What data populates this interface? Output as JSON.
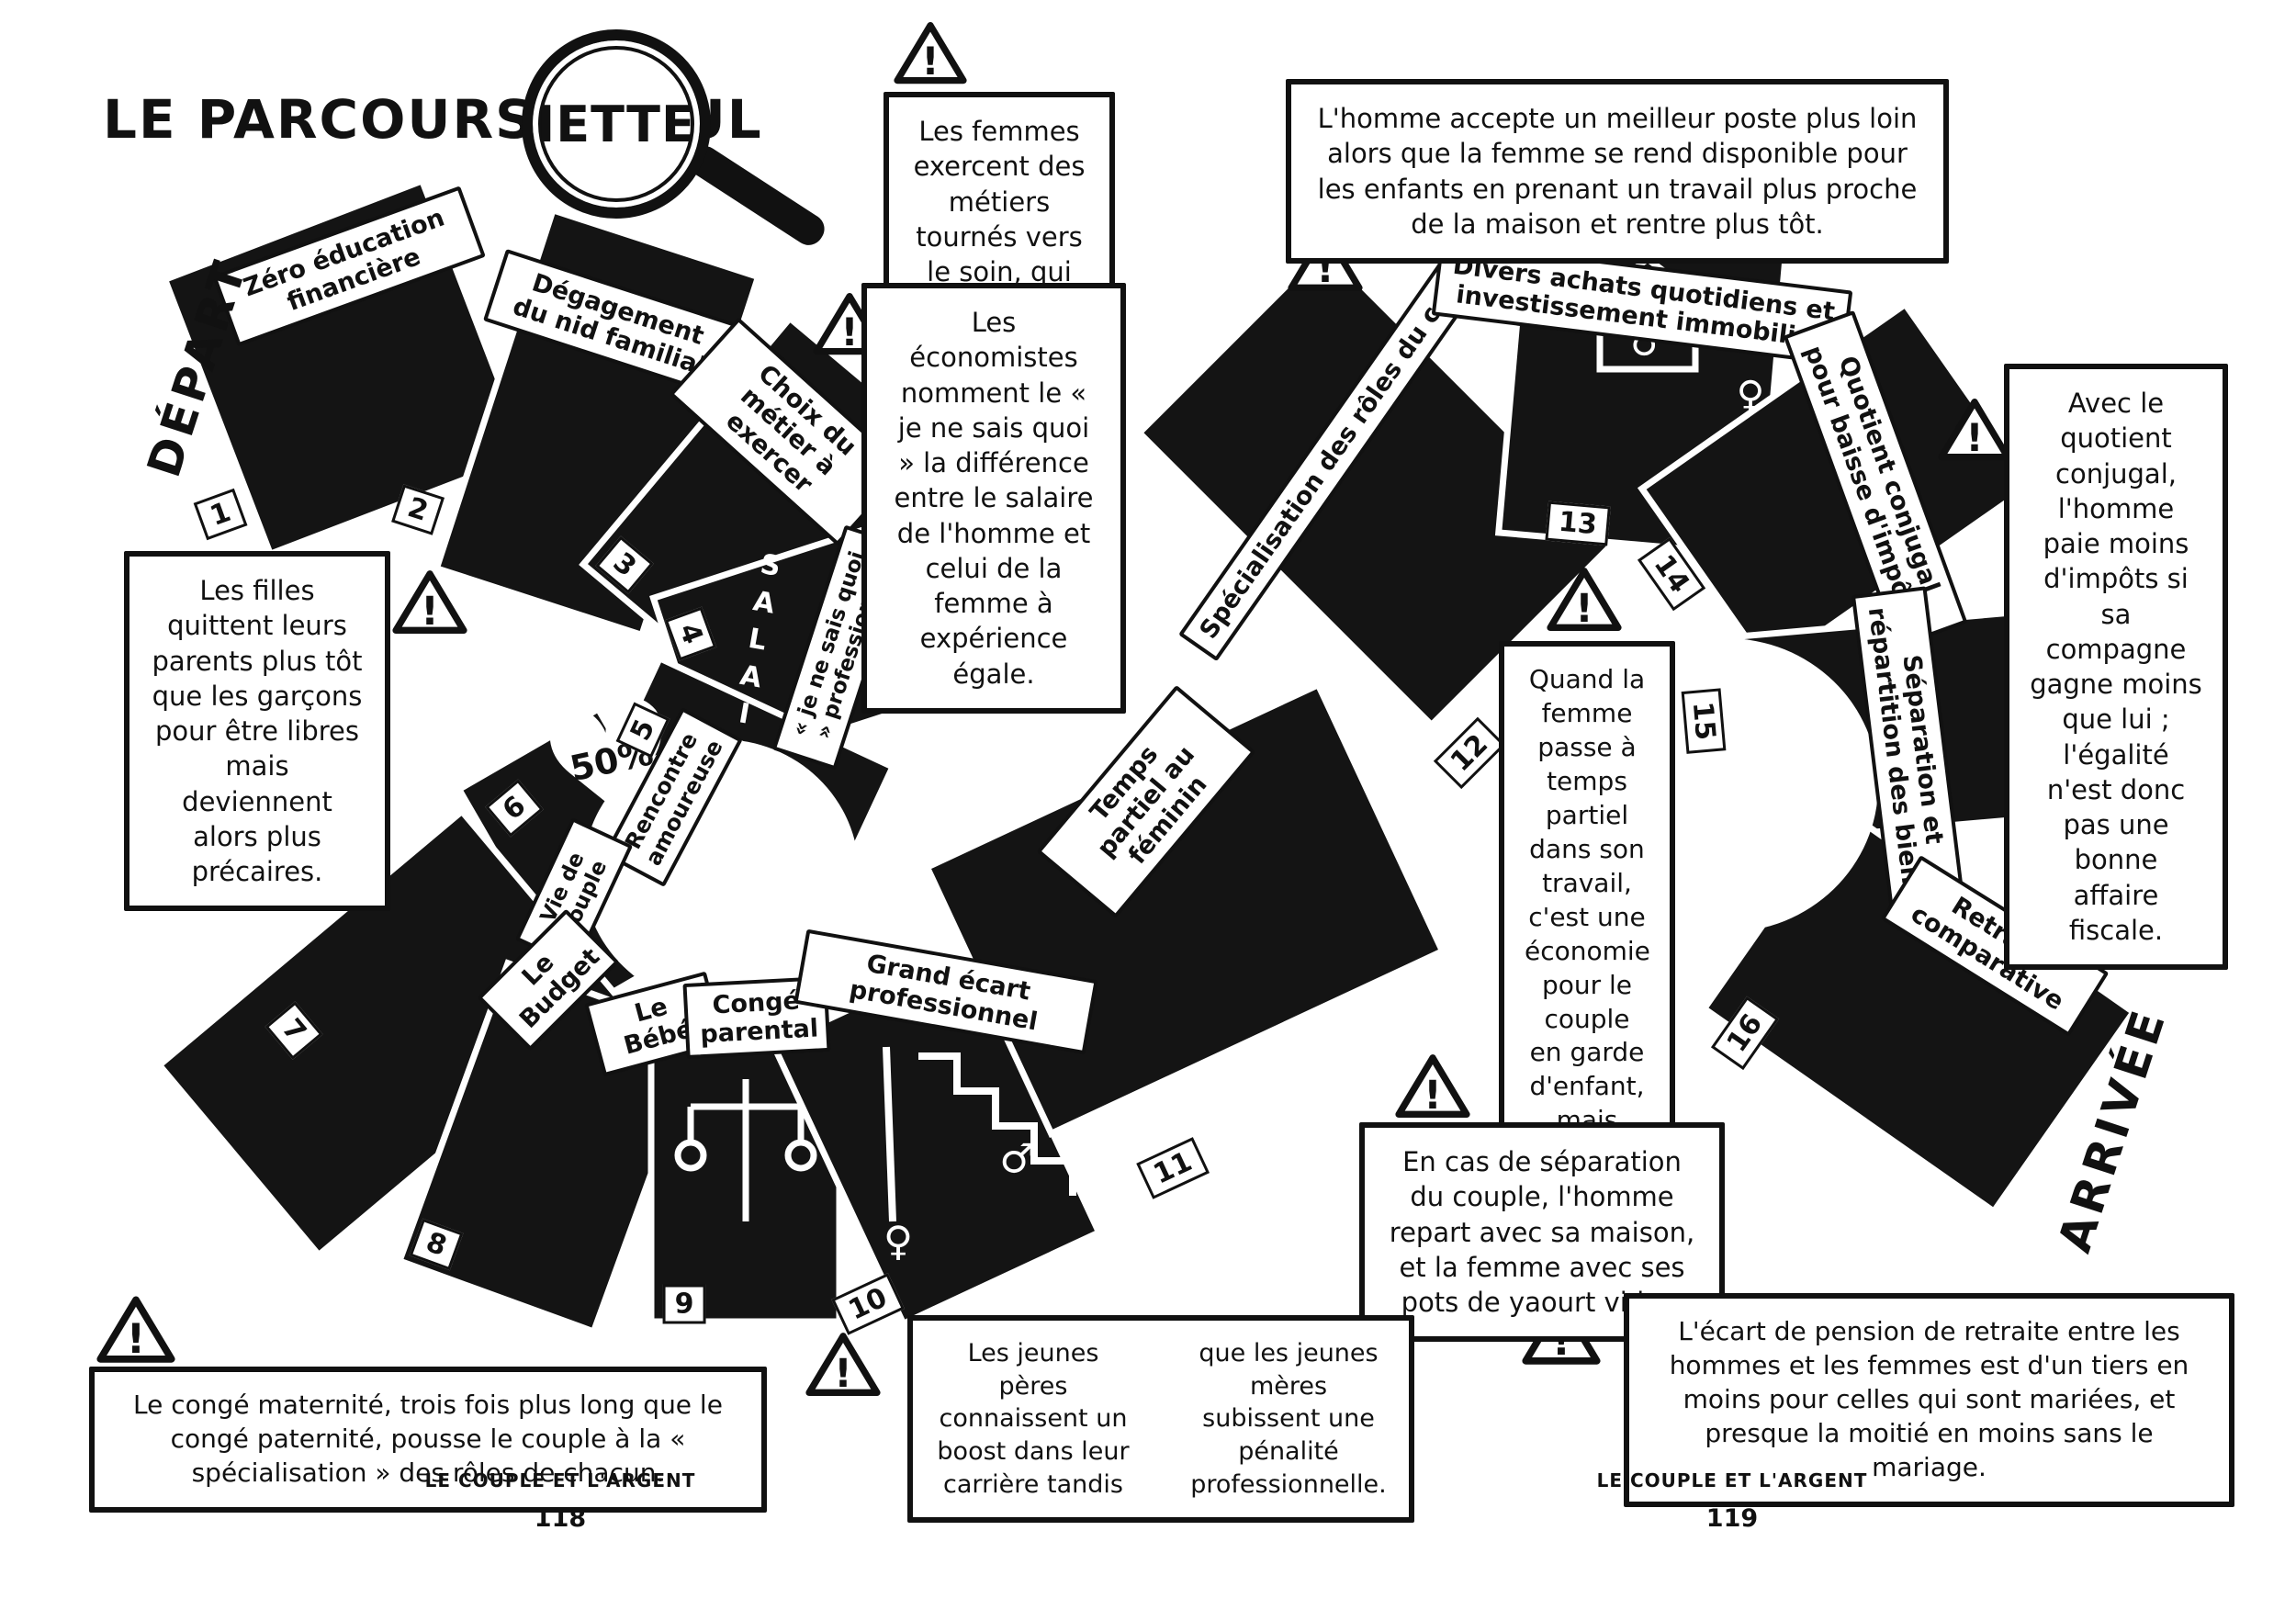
{
  "page": {
    "title_prefix": "LE PARCOURS DE JUL",
    "title_magnified": "IETTE",
    "start_label": "DÉPART",
    "finish_label": "ARRIVÉE",
    "footer_left": {
      "caption": "LE COUPLE ET L'ARGENT",
      "page_number": "118"
    },
    "footer_right": {
      "caption": "LE COUPLE ET L'ARGENT",
      "page_number": "119"
    }
  },
  "colors": {
    "ink": "#111111",
    "paper": "#ffffff"
  },
  "icons": {
    "warning_glyph": "!",
    "heart_glyph": "♥",
    "male_symbol": "♂",
    "female_symbol": "♀"
  },
  "board": {
    "tiles": [
      {
        "number": "1",
        "label": "Zéro éducation financière"
      },
      {
        "number": "2",
        "label": "Dégagement du nid familial"
      },
      {
        "number": "3",
        "label": "Choix du métier à exercer"
      },
      {
        "number": "4",
        "label": "Salaire",
        "sublabel": "« je ne sais quoi » professionnel"
      },
      {
        "number": "5",
        "label": "Rencontre amoureuse"
      },
      {
        "number": "6",
        "label": "Vie de couple",
        "badge": "50%"
      },
      {
        "number": "7",
        "label": "Le Budget"
      },
      {
        "number": "8",
        "label": "Le Bébé"
      },
      {
        "number": "9",
        "label": "Congé parental"
      },
      {
        "number": "10",
        "label": "Grand écart professionnel"
      },
      {
        "number": "11",
        "label": "Temps partiel au féminin"
      },
      {
        "number": "12",
        "label": "Spécialisation des rôles du couple"
      },
      {
        "number": "13",
        "label": "Divers achats quotidiens et investissement immobilier"
      },
      {
        "number": "14",
        "label": "Quotient conjugal pour baisse d'impôts"
      },
      {
        "number": "15",
        "label": "Séparation et répartition des biens"
      },
      {
        "number": "16",
        "label": "Retraite comparative"
      }
    ]
  },
  "warnings": [
    {
      "text": "Les femmes exercent des métiers tournés vers le soin, qui sont moins payés."
    },
    {
      "text": "Les économistes nomment le « je ne sais quoi » la différence entre le salaire de l'homme et celui de la femme à expérience égale."
    },
    {
      "text": "L'homme accepte un meilleur poste plus loin alors que la femme se rend disponible pour les enfants en prenant un travail plus proche de la maison et rentre plus tôt."
    },
    {
      "text": "Les filles quittent leurs parents plus tôt que les garçons pour être libres mais deviennent alors plus précaires."
    },
    {
      "text": "Avec le quotient conjugal, l'homme paie moins d'impôts si sa compagne gagne moins que lui ; l'égalité n'est donc pas une bonne affaire fiscale."
    },
    {
      "text": "Quand la femme passe à temps partiel dans son travail, c'est une économie pour le couple en garde d'enfant, mais c'est elle qui perd en salaire."
    },
    {
      "text": "En cas de séparation du couple, l'homme repart avec sa maison, et la femme avec ses pots de yaourt vides."
    },
    {
      "text": "Le congé maternité, trois fois plus long que le congé paternité, pousse le couple à la « spécialisation » des rôles de chacun."
    },
    {
      "text_left": "Les jeunes pères connaissent un boost dans leur carrière tandis",
      "text_right": "que les jeunes mères subissent une pénalité professionnelle."
    },
    {
      "text": "L'écart de pension de retraite entre les hommes et les femmes est d'un tiers en moins pour celles qui sont mariées, et presque la moitié en moins sans le mariage."
    }
  ]
}
